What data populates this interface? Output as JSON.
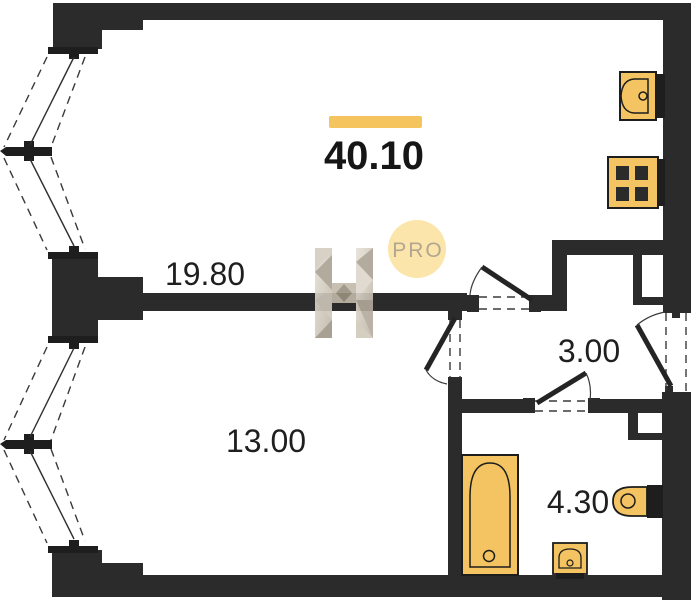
{
  "plan": {
    "total_area": "40.10",
    "rooms": {
      "living_kitchen": "19.80",
      "bedroom": "13.00",
      "hall": "3.00",
      "bathroom": "4.30"
    },
    "branding": {
      "logo_letter": "H",
      "badge": "PRO"
    },
    "colors": {
      "wall": "#2b2b2b",
      "fixture_fill": "#f4c463",
      "accent_bar": "#f5c45e",
      "badge_bg": "#fbe3a1",
      "badge_text": "#aa9d85",
      "background": "#ffffff",
      "label_text": "#1f1f1f"
    }
  }
}
